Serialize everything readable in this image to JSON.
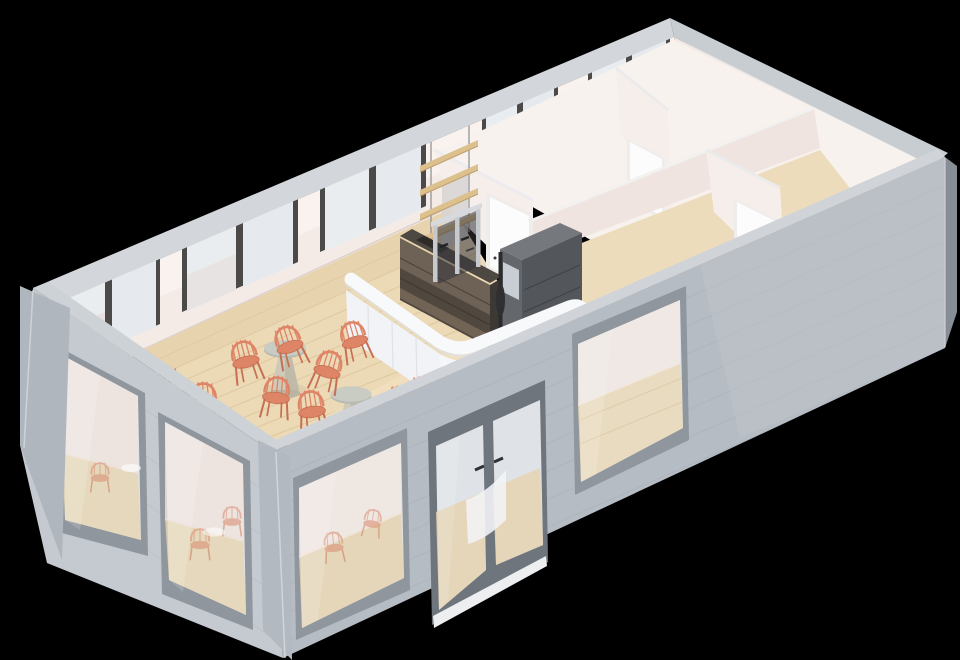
{
  "scene": {
    "description": "3D isometric cutaway render of a single-storey cafe building floor plan, viewed from above at an angle, on a black background",
    "view": "axonometric-cutaway-no-roof",
    "background": "#000000",
    "inventory": {
      "cafe_round_tables": 2,
      "coral_chairs": 12,
      "back_wall_windows": 5,
      "side_wall_windows": 1,
      "storefront_windows_left": 2,
      "storefront_windows_front": 2,
      "glass_double_doors": 1,
      "interior_white_doors": 3,
      "wall_shelves": 4,
      "espresso_machines": 1,
      "service_counters": 1,
      "back_counters": 1,
      "gray_cabinets": 1,
      "floor_lamps": 1,
      "back_rooms": 4
    }
  },
  "palette": {
    "background": "#000000",
    "facade_left": "#c5cad0",
    "facade_front": "#b6bcc4",
    "facade_edge_dark": "#878d95",
    "siding_line": "#a9afb7",
    "corner_post": "#b0b6bd",
    "parapet_cap": "#d3d7db",
    "ext_window_frame": "#8f969e",
    "ext_window_jamb": "#c6cbd1",
    "ext_glass": "#dfe3e7",
    "interior_wall": "#f4ebe7",
    "interior_wall_light": "#faf4f1",
    "partition_face": "#f6eeea",
    "partition_shadow": "#efe4df",
    "floor_wood": "#ecd9b5",
    "floor_plank_line": "#dcc59e",
    "floor_white": "#f8f2ee",
    "int_window_frame": "#4c4a49",
    "int_glass": "#e9edf0",
    "door_white": "#fcfcfd",
    "counter_white": "#f8f9fb",
    "counter_face": "#f1f3f6",
    "back_counter_face": "#6e6256",
    "back_counter_dark": "#3e3833",
    "shelf_wood": "#dcc08e",
    "cabinet_front": "#64676c",
    "cabinet_side": "#53565b",
    "chrome": "#c6cacf",
    "chair_coral": "#dd8566",
    "chair_coral_dark": "#c76f52",
    "table_top": "#c9ccc2",
    "table_base": "#cfc9b9",
    "lamp_black": "#2b2b2e"
  }
}
